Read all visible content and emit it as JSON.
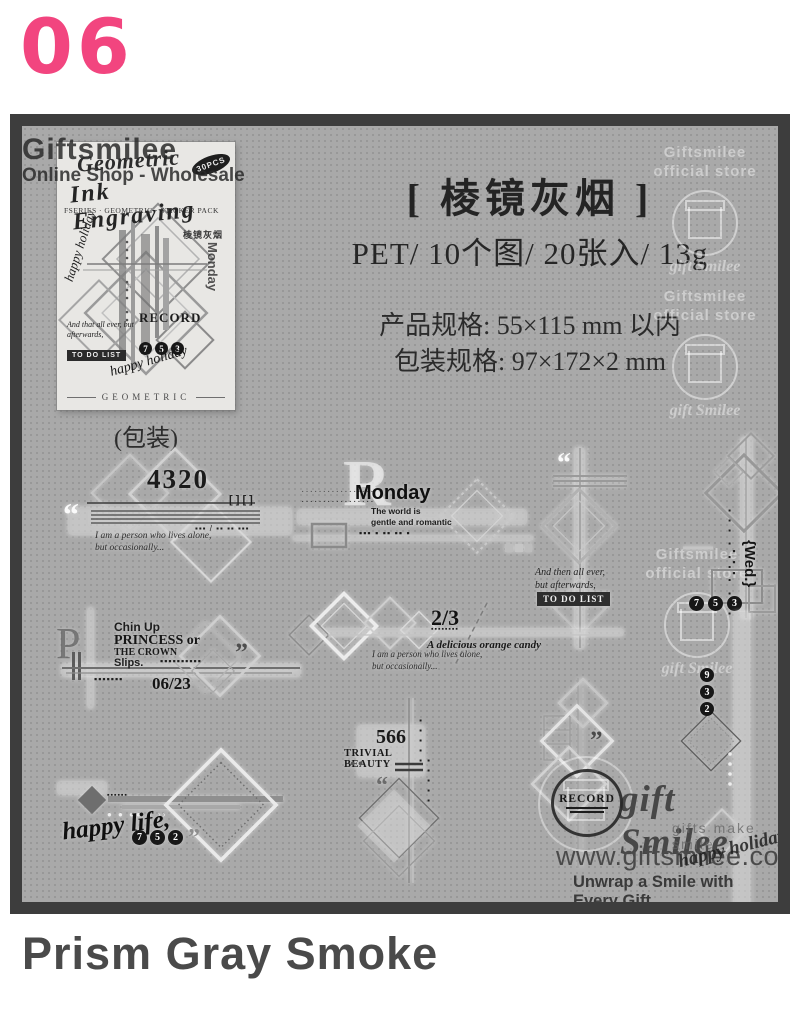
{
  "page": {
    "number": "06",
    "product_name": "Prism Gray Smoke"
  },
  "colors": {
    "accent_pink": "#f2457f",
    "panel_border": "#3d3d3d",
    "panel_bg": "#a9a9a9"
  },
  "watermark": {
    "shop": "Giftsmilee",
    "shop_sub": "Online Shop - Wholesale",
    "store1": "Giftsmilee",
    "store2": "official store",
    "logo": "gift Smilee"
  },
  "header": {
    "title": "[ 棱镜灰烟 ]",
    "subtitle": "PET/ 10个图/ 20张入/ 13g",
    "spec1": "产品规格: 55×115 mm 以内",
    "spec2": "包装规格: 97×172×2 mm"
  },
  "package": {
    "caption": "(包装)",
    "script1": "Geometric",
    "script2": "Ink Engraving",
    "badge": "30PCS",
    "series": "FSERIES · GEOMETRIC · STICKER PACK",
    "cn": "棱镜灰烟",
    "side_text": "Monday",
    "vertical_script": "happy holiday",
    "record": "RECORD",
    "digits": [
      "7",
      "5",
      "3"
    ],
    "todo": "TO DO LIST",
    "script3": "And that all ever, but afterwards,",
    "script4": "happy holiday",
    "footer": "GEOMETRIC"
  },
  "stickers": {
    "s4320": {
      "number": "4320",
      "brackets": "[ ] [ ]",
      "quote": "“",
      "dots": "▪▪▪ / ▪▪ ▪▪ ▪▪▪",
      "script1": "I am a person who lives alone,",
      "script2": "but occasionally..."
    },
    "monday": {
      "letter": "R",
      "title": "Monday",
      "line1": "The world is",
      "line2": "gentle and romantic",
      "dash1": "·················",
      "dash2": "·················",
      "dots": "▪▪▪  ▪  ▪▪  ▪▪  ▪"
    },
    "todo": {
      "quote": "“",
      "script1": "And then all ever,",
      "script2": "but afterwards,",
      "label": "TO DO LIST"
    },
    "wed": {
      "label": "{Wed.}",
      "dots": "▪▪▪ ▪ ▪▪ ▪ ▪▪▪",
      "squares": "▪▪▪",
      "digits": [
        "7",
        "5",
        "3"
      ]
    },
    "chinup": {
      "letter": "P",
      "line1": "Chin Up",
      "line2": "PRINCESS or",
      "line3": "THE CROWN",
      "line4": "Slips.",
      "dots1": "▪▪▪▪▪▪▪▪▪▪",
      "dots2": "▪▪▪▪▪▪▪",
      "date": "06/23",
      "quote": "”"
    },
    "twothirds": {
      "number": "2/3",
      "blocks": "▪▪▪▪▪▪▪▪",
      "caption": "A delicious orange candy",
      "script1": "I am a person who lives alone,",
      "script2": "but occasionally..."
    },
    "beauty": {
      "number": "566",
      "title": "TRIVIAL BEAUTY",
      "dots": "● ●",
      "quote": "“"
    },
    "chain": {
      "quote": "”"
    },
    "happylife": {
      "script": "happy life,",
      "digits": [
        "7",
        "5",
        "2"
      ],
      "quote": "”",
      "dots": "▪▪▪▪▪▪",
      "whitedots": "● ● ●● ● ››"
    },
    "right932": {
      "digits": [
        "9",
        "3",
        "2"
      ]
    }
  },
  "branding": {
    "record": "RECORD",
    "logo": "gift Smilee",
    "logo_sub": "gifts make smile",
    "website": "www.giftsmilee.com",
    "tagline": "Unwrap a Smile with Every Gift",
    "script": "happy holiday"
  }
}
